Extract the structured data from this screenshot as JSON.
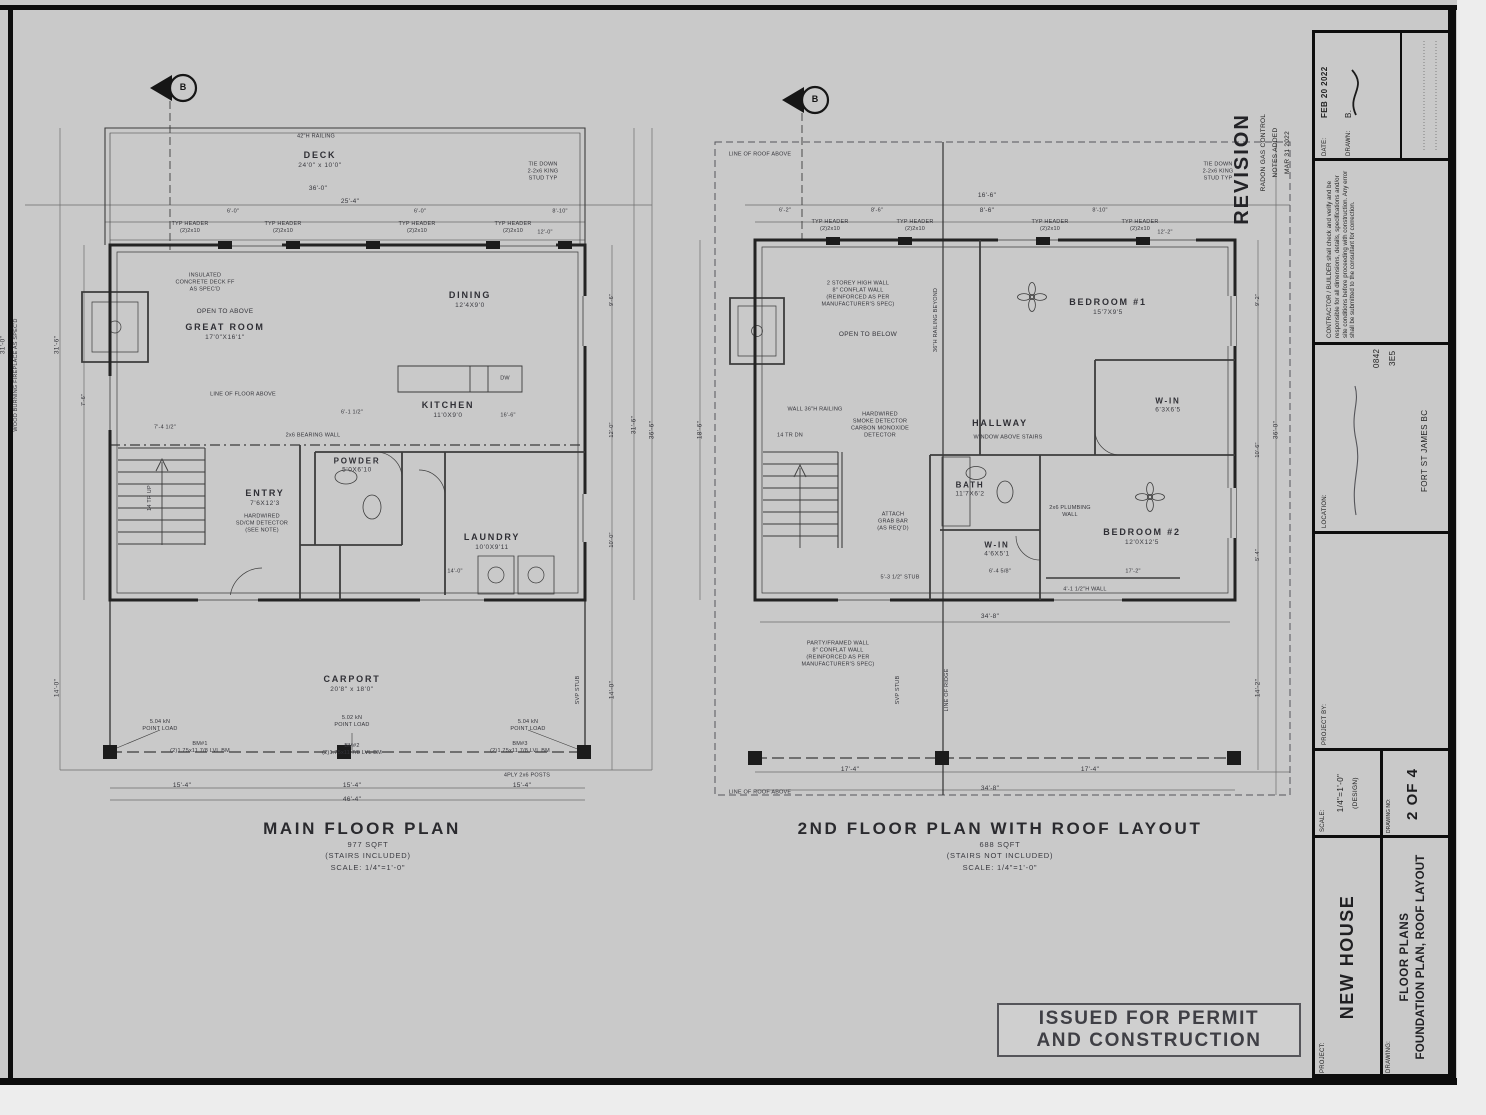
{
  "sheet": {
    "bg": "#c9c9c9",
    "line": "#3c3c3c",
    "border": "#0d0d0d"
  },
  "stamp": {
    "line1": "ISSUED FOR PERMIT",
    "line2": "AND CONSTRUCTION"
  },
  "revision": {
    "title": "REVISION",
    "line1": "RADON GAS CONTROL",
    "line2": "NOTES ADDED",
    "line3": "MAR 31 2022"
  },
  "shared": {
    "marker": "B",
    "typ_header1": "TYP HEADER",
    "typ_header2": "(2)2x10",
    "tie1": "TIE DOWN",
    "tie2": "2-2x6 KING",
    "tie3": "STUD TYP"
  },
  "titleblock": {
    "date_label": "DATE:",
    "date_value": "FEB 20 2022",
    "drawn_label": "DRAWN:",
    "drawn_value": "B.",
    "note": "CONTRACTOR / BUILDER shall check and verify and be responsible for all dimensions, details, specifications and/or site conditions before proceeding with construction. Any error shall be submitted to the consultant for correction.",
    "location_label": "LOCATION:",
    "location_line1": "0842",
    "location_line2": "3E5",
    "location_line3": "FORT ST JAMES BC",
    "project_by_label": "PROJECT BY:",
    "scale_label": "SCALE:",
    "scale_value": "1/4\"=1'-0\"",
    "scale_note": "(DESIGN)",
    "drawing_no_label": "DRAWING NO:",
    "drawing_no_value": "2 OF 4",
    "project_label": "PROJECT:",
    "project_value": "NEW HOUSE",
    "drawing_label": "DRAWING:",
    "drawing_value1": "FLOOR PLANS",
    "drawing_value2": "FOUNDATION PLAN, ROOF LAYOUT"
  },
  "main": {
    "title": "MAIN FLOOR PLAN",
    "area": "977 SQFT",
    "stairs": "(STAIRS INCLUDED)",
    "scale": "SCALE:  1/4\"=1'-0\"",
    "rooms": {
      "deck_n": "DECK",
      "deck_d": "24'0\" x 10'0\"",
      "great_note": "OPEN TO ABOVE",
      "great_n": "GREAT ROOM",
      "great_d": "17'0\"X16'1\"",
      "dining_n": "DINING",
      "dining_d": "12'4X9'0",
      "kitchen_n": "KITCHEN",
      "kitchen_d": "11'0X9'0",
      "powder_n": "POWDER",
      "powder_d": "5'0X6'10",
      "entry_n": "ENTRY",
      "entry_d": "7'6X12'3",
      "laundry_n": "LAUNDRY",
      "laundry_d": "10'0X9'11",
      "carport_n": "CARPORT",
      "carport_d": "20'8\" x 18'0\""
    },
    "ann": {
      "railing": "42\"H RAILING",
      "ins1": "INSULATED",
      "ins2": "CONCRETE DECK FF",
      "ins3": "AS SPEC'D",
      "fireplace": "WOOD BURNING FIREPLACE AS SPEC'D",
      "line_floor": "LINE OF FLOOR ABOVE",
      "bearing": "2x6 BEARING WALL",
      "sd1": "HARDWIRED",
      "sd2": "SD/CM DETECTOR",
      "sd3": "(SEE NOTE)",
      "tr": "14 TR UP",
      "dw": "DW",
      "bm1": "BM#1",
      "bm2": "BM#2",
      "bm3": "BM#3",
      "lvl": "(2)1.75x11 7/8 LVL BM",
      "pl1a": "5.04 kN",
      "pl1b": "POINT LOAD",
      "pl2a": "5.02 kN",
      "pl2b": "POINT LOAD",
      "posts": "4PLY 2x6 POSTS",
      "svp": "SVP STUB"
    },
    "dims": {
      "d36": "36'-0\"",
      "d254": "25'-4\"",
      "t1": "6'-0\"",
      "t2": "6'-0\"",
      "t3": "8'-10\"",
      "t4": "12'-0\"",
      "r1": "9'-6\"",
      "r2": "12'-0\"",
      "r3": "10'-0\"",
      "rt": "31'-6\"",
      "ro": "36'-6\"",
      "rb": "14'-0\"",
      "l1": "31'-6\"",
      "l2": "7'-6\"",
      "lb": "14'-0\"",
      "le": "31'-0\"",
      "b1": "15'-4\"",
      "b2": "15'-4\"",
      "b3": "15'-4\"",
      "bt": "46'-4\"",
      "m1": "7'-4 1/2\"",
      "m2": "6'-1 1/2\"",
      "m3": "16'-6\"",
      "m4": "14'-0\""
    }
  },
  "second": {
    "title": "2ND FLOOR PLAN WITH ROOF LAYOUT",
    "area": "688 SQFT",
    "stairs": "(STAIRS NOT INCLUDED)",
    "scale": "SCALE:  1/4\"=1'-0\"",
    "rooms": {
      "bed1_n": "BEDROOM #1",
      "bed1_d": "15'7X9'5",
      "hall_n": "HALLWAY",
      "win1_n": "W-IN",
      "win1_d": "6'3X6'5",
      "bath_n": "BATH",
      "bath_d": "11'7X6'2",
      "win2_n": "W-IN",
      "win2_d": "4'6X5'1",
      "bed2_n": "BEDROOM #2",
      "bed2_d": "12'0X12'5"
    },
    "ann": {
      "roof": "LINE OF ROOF ABOVE",
      "sw1": "2 STOREY HIGH WALL",
      "sw2": "8\" CONFLAT WALL",
      "sw3": "(REINFORCED AS PER",
      "sw4": "MANUFACTURER'S SPEC)",
      "open_below": "OPEN TO BELOW",
      "rail_beyond": "36\"H RAILING BEYOND",
      "wall_rail": "WALL 36\"H RAILING",
      "tr": "14 TR DN",
      "sd1": "HARDWIRED",
      "sd2": "SMOKE DETECTOR",
      "sd3": "CARBON MONOXIDE",
      "sd4": "DETECTOR",
      "window_above": "WINDOW ABOVE STAIRS",
      "grab1": "ATTACH",
      "grab2": "GRAB BAR",
      "grab3": "(AS REQ'D)",
      "plumb1": "2x6 PLUMBING",
      "plumb2": "WALL",
      "stub": "5'-3 1/2\" STUB",
      "half_wall": "4'-1 1/2\"H WALL",
      "pw1": "PARTY/FRAMED WALL",
      "pw2": "8\" CONFLAT WALL",
      "pw3": "(REINFORCED AS PER",
      "pw4": "MANUFACTURER'S SPEC)",
      "ridge": "LINE OF RIDGE",
      "svp": "SVP STUB"
    },
    "dims": {
      "t166": "16'-6\"",
      "t86": "8'-6\"",
      "t1": "6'-2\"",
      "t2": "8'-6\"",
      "t3": "8'-10\"",
      "t4": "12'-2\"",
      "r1": "9'-2\"",
      "r2": "10'-6\"",
      "r3": "5'-4\"",
      "ro": "36'-0\"",
      "rb": "14'-2\"",
      "lt": "18'-6\"",
      "b348": "34'-8\"",
      "b1": "17'-4\"",
      "b2": "17'-4\"",
      "bt": "34'-8\"",
      "m1": "17'-2\"",
      "m2": "6'-4 5/8\""
    }
  }
}
